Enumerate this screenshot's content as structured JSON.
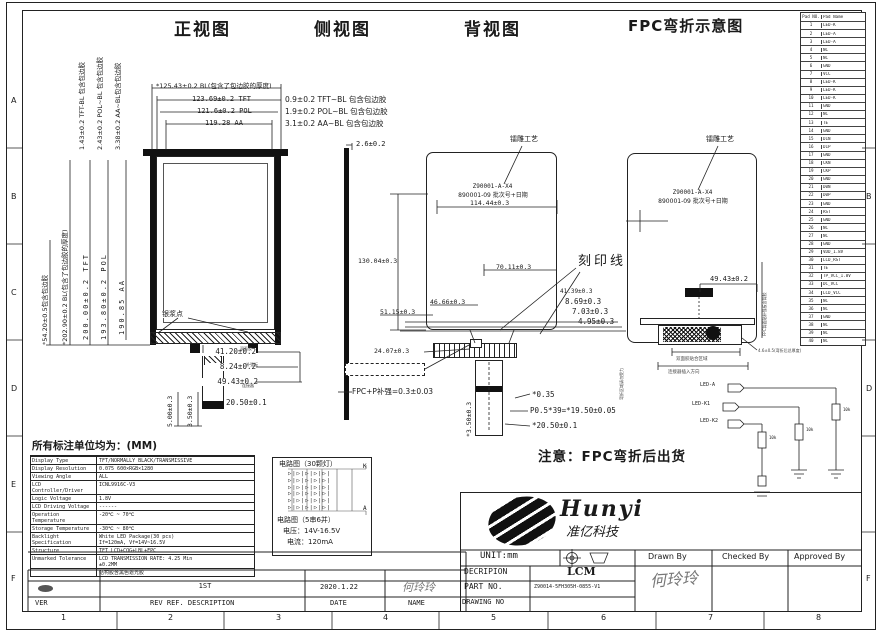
{
  "titles": {
    "front": "正视图",
    "side": "侧视图",
    "back": "背视图",
    "fpc": "FPC弯折示意图"
  },
  "frame": {
    "zone_letters": [
      "A",
      "B",
      "C",
      "D",
      "E",
      "F"
    ],
    "zone_numbers": [
      "1",
      "2",
      "3",
      "4",
      "5",
      "6",
      "7",
      "8"
    ]
  },
  "front": {
    "dims_top": [
      "*125.43±0.2 BL(包含了包边胶的厚度)",
      "123.69±0.2 TFT",
      "121.6±0.2 POL",
      "119.28 AA"
    ],
    "dims_right": [
      "0.9±0.2 TFT~BL 包含包边胶",
      "1.9±0.2 POL~BL 包含包边胶",
      "3.1±0.2 AA~BL 包含包边胶"
    ],
    "dims_left_rot": [
      "1.43±0.2 TFT-BL 包含包边胶",
      "2.43±0.2 POL~BL 包含包边胶",
      "3.38±0.2 AA~BL包含包边胶"
    ],
    "dims_left_v": [
      "*54.20±0.5包含包边胶",
      "*202.90±0.2 BL(包含了包边胶的厚度)",
      "200.00±0.2 TFT",
      "193.80±0.2 POL",
      "190.85 AA"
    ],
    "dims_bottom": [
      "41.20±0.2",
      "8.24±0.2",
      "49.43±0.2"
    ],
    "dims_tail_rot": [
      "5.00±0.3",
      "3.50±0.3"
    ],
    "dim_tail_w": "20.50±0.1",
    "silver_dot_label": "银浆点",
    "tail_labels": [
      "双面胶",
      "补强板",
      "连接器"
    ]
  },
  "side": {
    "dim_top": "2.6±0.2",
    "fpc_label": "FPC+P补强=0.3±0.03",
    "dim_pin": "*0.35",
    "dim_pitch": "P0.5*39=*19.50±0.05",
    "dim_w": "*20.50±0.1",
    "dim_h_rot": "*3.50±0.3"
  },
  "back": {
    "laser_label": "镭雕工艺",
    "code_line1": "Z90001-A-X4",
    "code_line2": "890001-09 批次号+日期",
    "engrave_label": "刻印线",
    "dims": {
      "w_top": "114.44±0.3",
      "h_left": "130.04±0.3",
      "d1": "70.11±0.3",
      "d2": "46.66±0.3",
      "d3": "51.15±0.3",
      "s1": "41.39±0.3",
      "s2": "8.69±0.3",
      "s3": "7.03±0.3",
      "s4": "4.95±0.3",
      "d4": "24.07±0.3"
    }
  },
  "fpc": {
    "laser_label": "镭雕工艺",
    "code_line1": "Z90001-A-X4",
    "code_line2": "890001-09 批次号+日期",
    "dim": "49.43±0.2",
    "small_right_rot": "FPC背面贴补强板含背胶",
    "small_left_rot": "弯折区域请勿受力",
    "note1": "4.6±0.5(弯折后总厚度)",
    "note2": "双面胶贴合区域",
    "note3": "连接器插入方向",
    "schematic": {
      "labels": [
        "LED-A",
        "LED-K1",
        "LED-K2"
      ],
      "resistor": "10k"
    }
  },
  "note": "注意：FPC弯折后出货",
  "units_note": "所有标注单位均为：(MM)",
  "spec_table": {
    "rows": [
      {
        "label": "Display Type",
        "value": "TFT/NORMALLY BLACK/TRANSMISSIVE"
      },
      {
        "label": "Display Resolution",
        "value": "0.075 600×RGB×1280"
      },
      {
        "label": "Viewing Angle",
        "value": "ALL"
      },
      {
        "label": "LCD Controller/Driver",
        "value": "ICNL9916C-V3"
      },
      {
        "label": "Logic Voltage",
        "value": "1.8V"
      },
      {
        "label": "LCD Driving Voltage",
        "value": "------"
      },
      {
        "label": "Operation Temperature",
        "value": "-20℃ ~ 70℃"
      },
      {
        "label": "Storage Temperature",
        "value": "-30℃ ~ 80℃"
      },
      {
        "label": "Backlight Specification",
        "value": "White LED Package(30 pcs)\nIf=120mA, Vf=14V~16.5V"
      },
      {
        "label": "Structure",
        "value": "TFT LCD+COG+LBL+FPC"
      },
      {
        "label": "Unmarked Tolerance",
        "value": "LCD TRANSMISSION RATE: 4.25 Min\n±0.2MM"
      },
      {
        "label": "",
        "value": "结构胶含黑色遮光胶"
      }
    ]
  },
  "backlight_box": {
    "title1": "电路图（30颗灯）",
    "title2": "电路图（5串6并）",
    "voltage": "电压：14V-16.5V",
    "current": "电流：120mA",
    "k": "K",
    "a": "A",
    "led_rows": [
      "▷|▷|▷|▷|▷|",
      "▷|▷|▷|▷|▷|",
      "▷|▷|▷|▷|▷|",
      "▷|▷|▷|▷|▷|",
      "▷|▷|▷|▷|▷|",
      "▷|▷|▷|▷|▷|"
    ]
  },
  "pin_table": {
    "headers": [
      "Pad NO.",
      "Pad Name"
    ],
    "rows": [
      {
        "no": "1",
        "name": "LED-K"
      },
      {
        "no": "2",
        "name": "LED-A"
      },
      {
        "no": "3",
        "name": "LED-A"
      },
      {
        "no": "4",
        "name": "NC"
      },
      {
        "no": "5",
        "name": "NC"
      },
      {
        "no": "6",
        "name": "GND"
      },
      {
        "no": "7",
        "name": "VCC"
      },
      {
        "no": "8",
        "name": "LED-K"
      },
      {
        "no": "9",
        "name": "LED-K"
      },
      {
        "no": "10",
        "name": "LED-K"
      },
      {
        "no": "11",
        "name": "GND"
      },
      {
        "no": "12",
        "name": "NC"
      },
      {
        "no": "13",
        "name": "TE"
      },
      {
        "no": "14",
        "name": "GND"
      },
      {
        "no": "15",
        "name": "D1N"
      },
      {
        "no": "16",
        "name": "D1P"
      },
      {
        "no": "17",
        "name": "GND"
      },
      {
        "no": "18",
        "name": "CKN"
      },
      {
        "no": "19",
        "name": "CKP"
      },
      {
        "no": "20",
        "name": "GND"
      },
      {
        "no": "21",
        "name": "D0N"
      },
      {
        "no": "22",
        "name": "D0P"
      },
      {
        "no": "23",
        "name": "GND"
      },
      {
        "no": "24",
        "name": "RST"
      },
      {
        "no": "25",
        "name": "GND"
      },
      {
        "no": "26",
        "name": "NC"
      },
      {
        "no": "27",
        "name": "NC"
      },
      {
        "no": "28",
        "name": "GND"
      },
      {
        "no": "29",
        "name": "VDD_1.8V"
      },
      {
        "no": "30",
        "name": "LCD_RST"
      },
      {
        "no": "31",
        "name": "TE"
      },
      {
        "no": "32",
        "name": "TP_VCC_1.8V"
      },
      {
        "no": "33",
        "name": "DC_VCC"
      },
      {
        "no": "34",
        "name": "LCD_VCC"
      },
      {
        "no": "35",
        "name": "NC"
      },
      {
        "no": "36",
        "name": "NC"
      },
      {
        "no": "37",
        "name": "GND"
      },
      {
        "no": "38",
        "name": "NC"
      },
      {
        "no": "39",
        "name": "NC"
      },
      {
        "no": "40",
        "name": "NC"
      }
    ]
  },
  "logo": {
    "name": "Hunyi",
    "cn": "准亿科技"
  },
  "title_block": {
    "unit": "UNIT:mm",
    "decription_label": "DECRIPION",
    "decription": "LCM",
    "part_label": "PART NO.",
    "part_no": "Z90014-5FH305H-0855-V1",
    "drawing_label": "DRAWING NO",
    "drawn": "Drawn By",
    "checked": "Checked By",
    "approved": "Approved By",
    "drawn_sign": "何玲玲"
  },
  "rev_table": {
    "headers": [
      "VER",
      "REV REF. DESCRIPTION",
      "DATE",
      "NAME"
    ],
    "row": {
      "desc": "1ST",
      "date": "2020.1.22",
      "name": "何玲玲"
    }
  },
  "colors": {
    "line": "#222222",
    "paper": "#ffffff",
    "sign": "#777777"
  }
}
